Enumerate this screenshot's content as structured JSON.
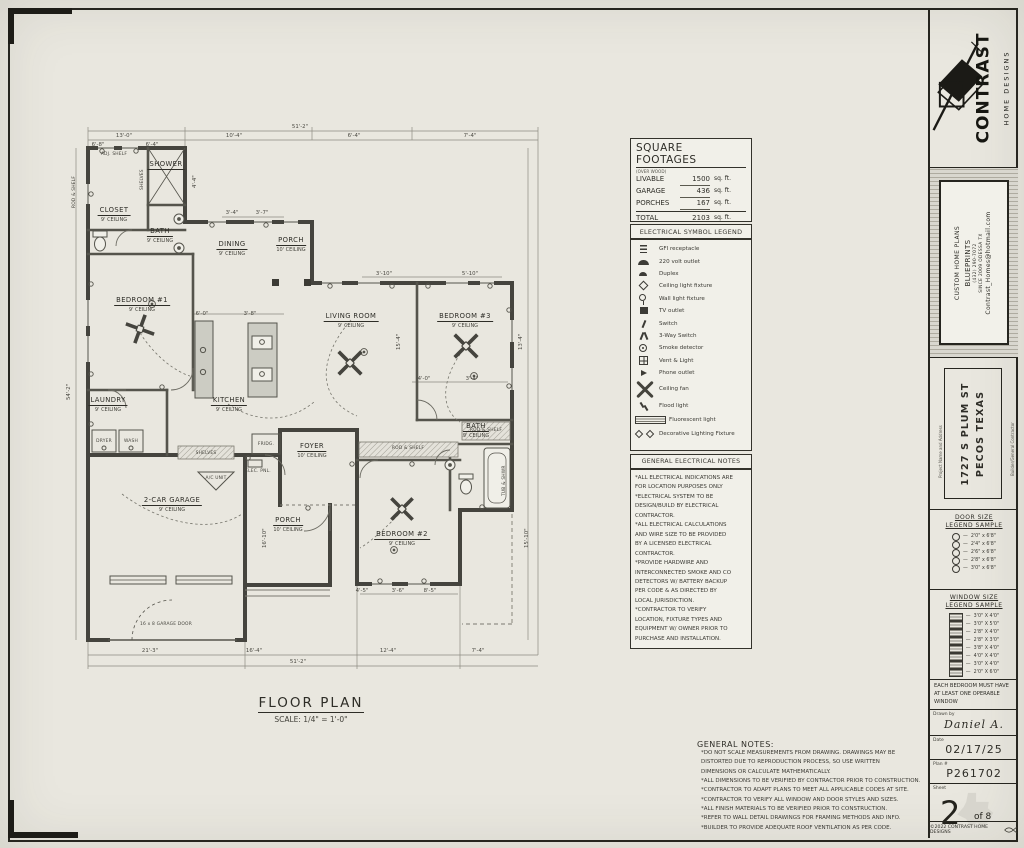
{
  "sheet": {
    "floor_plan_title": "FLOOR PLAN",
    "floor_plan_scale": "SCALE: 1/4\" = 1'-0\""
  },
  "square_footages": {
    "title": "SQUARE FOOTAGES",
    "subtitle": "(OVER WOOD)",
    "rows": [
      {
        "label": "LIVABLE",
        "value": "1500",
        "unit": "sq. ft."
      },
      {
        "label": "GARAGE",
        "value": "436",
        "unit": "sq. ft."
      },
      {
        "label": "PORCHES",
        "value": "167",
        "unit": "sq. ft."
      },
      {
        "label": "TOTAL",
        "value": "2103",
        "unit": "sq. ft."
      }
    ]
  },
  "electrical_legend": {
    "title": "ELECTRICAL SYMBOL LEGEND",
    "items": [
      {
        "icon": "gfi",
        "label": "GFI receptacle"
      },
      {
        "icon": "outlet220",
        "label": "220 volt outlet"
      },
      {
        "icon": "duplex",
        "label": "Duplex"
      },
      {
        "icon": "ceiling-light",
        "label": "Ceiling light fixture"
      },
      {
        "icon": "wall-light",
        "label": "Wall light fixture"
      },
      {
        "icon": "tv-outlet",
        "label": "TV outlet"
      },
      {
        "icon": "switch",
        "label": "Switch"
      },
      {
        "icon": "switch3",
        "label": "3-Way Switch"
      },
      {
        "icon": "smoke-detector",
        "label": "Smoke detector"
      },
      {
        "icon": "vent-light",
        "label": "Vent & Light"
      },
      {
        "icon": "phone-outlet",
        "label": "Phone outlet"
      },
      {
        "icon": "ceiling-fan",
        "label": "Ceiling fan",
        "size": "big"
      },
      {
        "icon": "flood-light",
        "label": "Flood light",
        "size": "med"
      },
      {
        "icon": "fluorescent",
        "label": "Fluorescent light",
        "size": "med"
      },
      {
        "icon": "decorative",
        "label": "Decorative Lighting Fixture",
        "size": "med"
      }
    ]
  },
  "electrical_notes": {
    "title": "GENERAL ELECTRICAL NOTES",
    "lines": [
      "*ALL ELECTRICAL INDICATIONS ARE",
      "FOR LOCATION PURPOSES ONLY",
      "*ELECTRICAL SYSTEM TO BE",
      "DESIGN/BUILD BY ELECTRICAL",
      "CONTRACTOR.",
      "*ALL ELECTRICAL CALCULATIONS",
      "AND WIRE SIZE TO BE PROVIDED",
      "BY A LICENSED ELECTRICAL",
      "CONTRACTOR.",
      "*PROVIDE HARDWIRE AND",
      "INTERCONNECTED SMOKE AND CO",
      "DETECTORS W/ BATTERY BACKUP",
      "PER CODE & AS DIRECTED BY",
      "LOCAL JURISDICTION.",
      "*CONTRACTOR TO VERIFY",
      "LOCATION, FIXTURE TYPES AND",
      "EQUIPMENT W/ OWNER PRIOR TO",
      "PURCHASE AND INSTALLATION."
    ]
  },
  "general_notes": {
    "title": "GENERAL NOTES:",
    "lines": [
      "*DO NOT SCALE MEASUREMENTS FROM DRAWING. DRAWINGS MAY BE",
      "DISTORTED DUE TO REPRODUCTION PROCESS, SO USE WRITTEN",
      "DIMENSIONS OR CALCULATE MATHEMATICALLY.",
      "*ALL DIMENSIONS TO BE VERIFIED BY CONTRACTOR PRIOR TO CONSTRUCTION.",
      "*CONTRACTOR TO ADAPT PLANS TO MEET ALL APPLICABLE CODES AT SITE.",
      "*CONTRACTOR TO VERIFY ALL WINDOW AND DOOR STYLES AND SIZES.",
      "*ALL FINISH MATERIALS TO BE VERIFIED PRIOR TO CONSTRUCTION.",
      "*REFER TO WALL DETAIL DRAWINGS FOR FRAMING METHODS AND INFO.",
      "*BUILDER TO PROVIDE ADEQUATE ROOF VENTILATION AS PER CODE."
    ]
  },
  "title_block": {
    "brand_main": "CONTRAST",
    "brand_sub": "HOME DESIGNS",
    "contact_lines": [
      "CUSTOM HOME PLANS",
      "BLUEPRINTS",
      "(432) 290-7072",
      "SINCE 2009  ODESSA TX",
      "Contrast_Homes@hotmail.com"
    ],
    "project_label": "Project Name and Address",
    "address_line1": "1727 S PLUM ST",
    "address_line2": "PECOS TEXAS",
    "builder_label": "Builder/General Contractor",
    "door_legend": {
      "title1": "DOOR SIZE",
      "title2": "LEGEND SAMPLE",
      "dash": "—",
      "items": [
        "2'0\" x 6'8\"",
        "2'4\" x 6'8\"",
        "2'6\" x 6'8\"",
        "2'8\" x 6'8\"",
        "3'0\" x 6'8\""
      ]
    },
    "window_legend": {
      "title1": "WINDOW SIZE",
      "title2": "LEGEND SAMPLE",
      "dash": "—",
      "items": [
        "3'0\" X 4'0\"",
        "3'0\" X 5'0\"",
        "2'8\" X 4'0\"",
        "2'8\" X 3'0\"",
        "3'8\" X 4'0\"",
        "4'0\" X 4'0\"",
        "3'0\" X 4'0\"",
        "2'0\" X 6'0\""
      ]
    },
    "bedroom_note": "EACH BEDROOM MUST HAVE AT LEAST ONE OPERABLE WINDOW",
    "drawn_by_label": "Drawn by",
    "drawn_by": "Daniel A.",
    "date_label": "Date",
    "date": "02/17/25",
    "plan_label": "Plan #",
    "plan_number": "P261702",
    "sheet_label": "Sheet",
    "sheet_number": "2",
    "sheet_of": "of 8",
    "copyright": "©2022 CONTRAST HOME DESIGNS"
  },
  "plan": {
    "rooms": {
      "closet": {
        "name": "CLOSET",
        "ceiling": "9' CEILING"
      },
      "shower": {
        "name": "SHOWER",
        "ceiling": ""
      },
      "bath1": {
        "name": "BATH",
        "ceiling": "9' CEILING"
      },
      "dining": {
        "name": "DINING",
        "ceiling": "9' CEILING"
      },
      "porch_entry": {
        "name": "PORCH",
        "ceiling": "10' CEILING"
      },
      "bedroom1": {
        "name": "BEDROOM #1",
        "ceiling": "9' CEILING"
      },
      "living": {
        "name": "LIVING ROOM",
        "ceiling": "9' CEILING"
      },
      "bedroom3": {
        "name": "BEDROOM #3",
        "ceiling": "9' CEILING"
      },
      "kitchen": {
        "name": "KITCHEN",
        "ceiling": "9' CEILING"
      },
      "laundry": {
        "name": "LAUNDRY",
        "ceiling": "9' CEILING"
      },
      "foyer": {
        "name": "FOYER",
        "ceiling": "10' CEILING"
      },
      "garage": {
        "name": "2-CAR GARAGE",
        "ceiling": "9' CEILING"
      },
      "porch_front": {
        "name": "PORCH",
        "ceiling": "10' CEILING"
      },
      "bedroom2": {
        "name": "BEDROOM #2",
        "ceiling": "9' CEILING"
      },
      "bath2": {
        "name": "BATH",
        "ceiling": "9' CEILING"
      }
    },
    "dimensions": [
      {
        "t": "51'-2\"",
        "x": 238,
        "y": 0
      },
      {
        "t": "13'-0\"",
        "x": 62,
        "y": 9
      },
      {
        "t": "10'-4\"",
        "x": 172,
        "y": 9
      },
      {
        "t": "6'-4\"",
        "x": 292,
        "y": 9
      },
      {
        "t": "7'-4\"",
        "x": 408,
        "y": 9
      },
      {
        "t": "6'-8\"",
        "x": 36,
        "y": 18
      },
      {
        "t": "6'-4\"",
        "x": 90,
        "y": 18
      },
      {
        "t": "3'-4\"",
        "x": 170,
        "y": 86
      },
      {
        "t": "3'-7\"",
        "x": 200,
        "y": 86
      },
      {
        "t": "3'-10\"",
        "x": 322,
        "y": 147
      },
      {
        "t": "5'-10\"",
        "x": 408,
        "y": 147
      },
      {
        "t": "6'-0\"",
        "x": 140,
        "y": 187
      },
      {
        "t": "3'-8\"",
        "x": 188,
        "y": 187
      },
      {
        "t": "4'-0\"",
        "x": 362,
        "y": 252
      },
      {
        "t": "3'-4\"",
        "x": 410,
        "y": 252
      },
      {
        "t": "4'-5\"",
        "x": 300,
        "y": 464
      },
      {
        "t": "3'-6\"",
        "x": 336,
        "y": 464
      },
      {
        "t": "8'-5\"",
        "x": 368,
        "y": 464
      },
      {
        "t": "21'-3\"",
        "x": 88,
        "y": 524
      },
      {
        "t": "16'-4\"",
        "x": 192,
        "y": 524
      },
      {
        "t": "12'-4\"",
        "x": 326,
        "y": 524
      },
      {
        "t": "7'-4\"",
        "x": 416,
        "y": 524
      },
      {
        "t": "51'-2\"",
        "x": 236,
        "y": 535
      },
      {
        "t": "54'-2\"",
        "x": 4,
        "y": 276,
        "rot": true
      },
      {
        "t": "4'-4\"",
        "x": 130,
        "y": 64,
        "rot": true
      },
      {
        "t": "15'-4\"",
        "x": 334,
        "y": 226,
        "rot": true
      },
      {
        "t": "13'-4\"",
        "x": 456,
        "y": 226,
        "rot": true
      },
      {
        "t": "15'-10\"",
        "x": 462,
        "y": 424,
        "rot": true
      },
      {
        "t": "16'-10\"",
        "x": 200,
        "y": 424,
        "rot": true
      }
    ],
    "fixtures": [
      {
        "t": "ADJ. SHELF",
        "x": 52,
        "y": 28
      },
      {
        "t": "ROD & SHELF",
        "x": 10,
        "y": 84,
        "rot": true
      },
      {
        "t": "SHELVES",
        "x": 78,
        "y": 66,
        "rot": true
      },
      {
        "t": "DRYER",
        "x": 42,
        "y": 315
      },
      {
        "t": "WASH",
        "x": 69,
        "y": 315
      },
      {
        "t": "SHELVES",
        "x": 144,
        "y": 327
      },
      {
        "t": "FRIDG.",
        "x": 204,
        "y": 318
      },
      {
        "t": "ELEC. PNL.",
        "x": 196,
        "y": 345
      },
      {
        "t": "A/C UNIT",
        "x": 154,
        "y": 352
      },
      {
        "t": "ROD & SHELF",
        "x": 346,
        "y": 322
      },
      {
        "t": "ROD & SHELF",
        "x": 424,
        "y": 304
      },
      {
        "t": "TUB & SHWR",
        "x": 440,
        "y": 372,
        "rot": true
      },
      {
        "t": "16 x 8 GARAGE DOOR",
        "x": 104,
        "y": 498
      }
    ]
  }
}
